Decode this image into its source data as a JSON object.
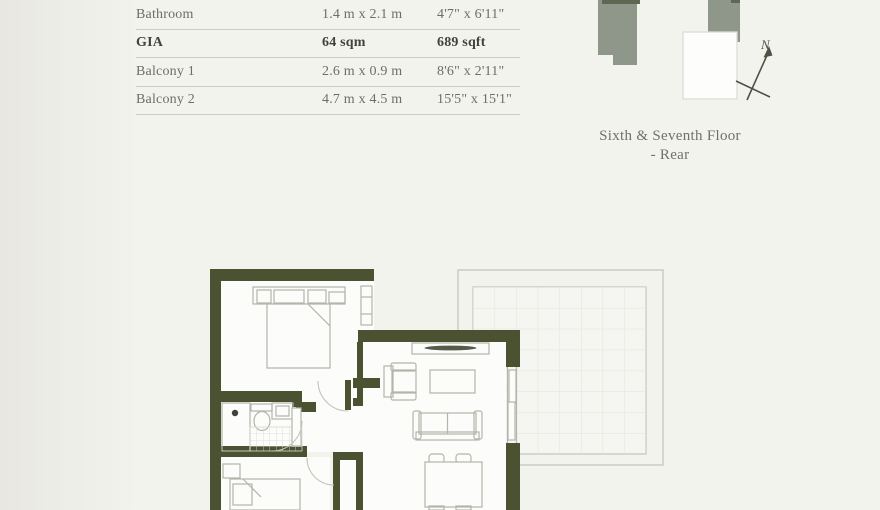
{
  "dimensions_table": {
    "rows": [
      {
        "label": "Bathroom",
        "metric": "1.4 m x 2.1 m",
        "imperial": "4'7\" x 6'11\""
      },
      {
        "label": "GIA",
        "metric": "64 sqm",
        "imperial": "689 sqft"
      },
      {
        "label": "Balcony 1",
        "metric": "2.6 m x 0.9 m",
        "imperial": "8'6\" x 2'11\""
      },
      {
        "label": "Balcony 2",
        "metric": "4.7 m x 4.5 m",
        "imperial": "15'5\" x 15'1\""
      }
    ]
  },
  "site_plan": {
    "north_label": "N",
    "caption_line1": "Sixth & Seventh Floor",
    "caption_line2": "- Rear"
  },
  "colors": {
    "background": "#f3f3ee",
    "wall": "#4a5231",
    "floor": "#fcfcfa",
    "divider": "#cbccc0",
    "table_text": "#6b7060",
    "table_text_bold": "#3f4536",
    "caption_text": "#6d7364",
    "furniture_line": "#b2b6aa",
    "arc_line": "#c2c5b9",
    "balcony_line": "#c6c8bc",
    "balcony_grid": "#e3e4da",
    "balcony_fill": "#f5f5f1",
    "tile_line": "#d9dbd0",
    "building": "#8e978a",
    "building_dark": "#5f6752",
    "unit_fill": "#fdfdfb",
    "unit_stroke": "#dcded4",
    "arrow": "#4d5243",
    "tv_dark": "#555b4a",
    "drain_dot": "#3e4435"
  }
}
